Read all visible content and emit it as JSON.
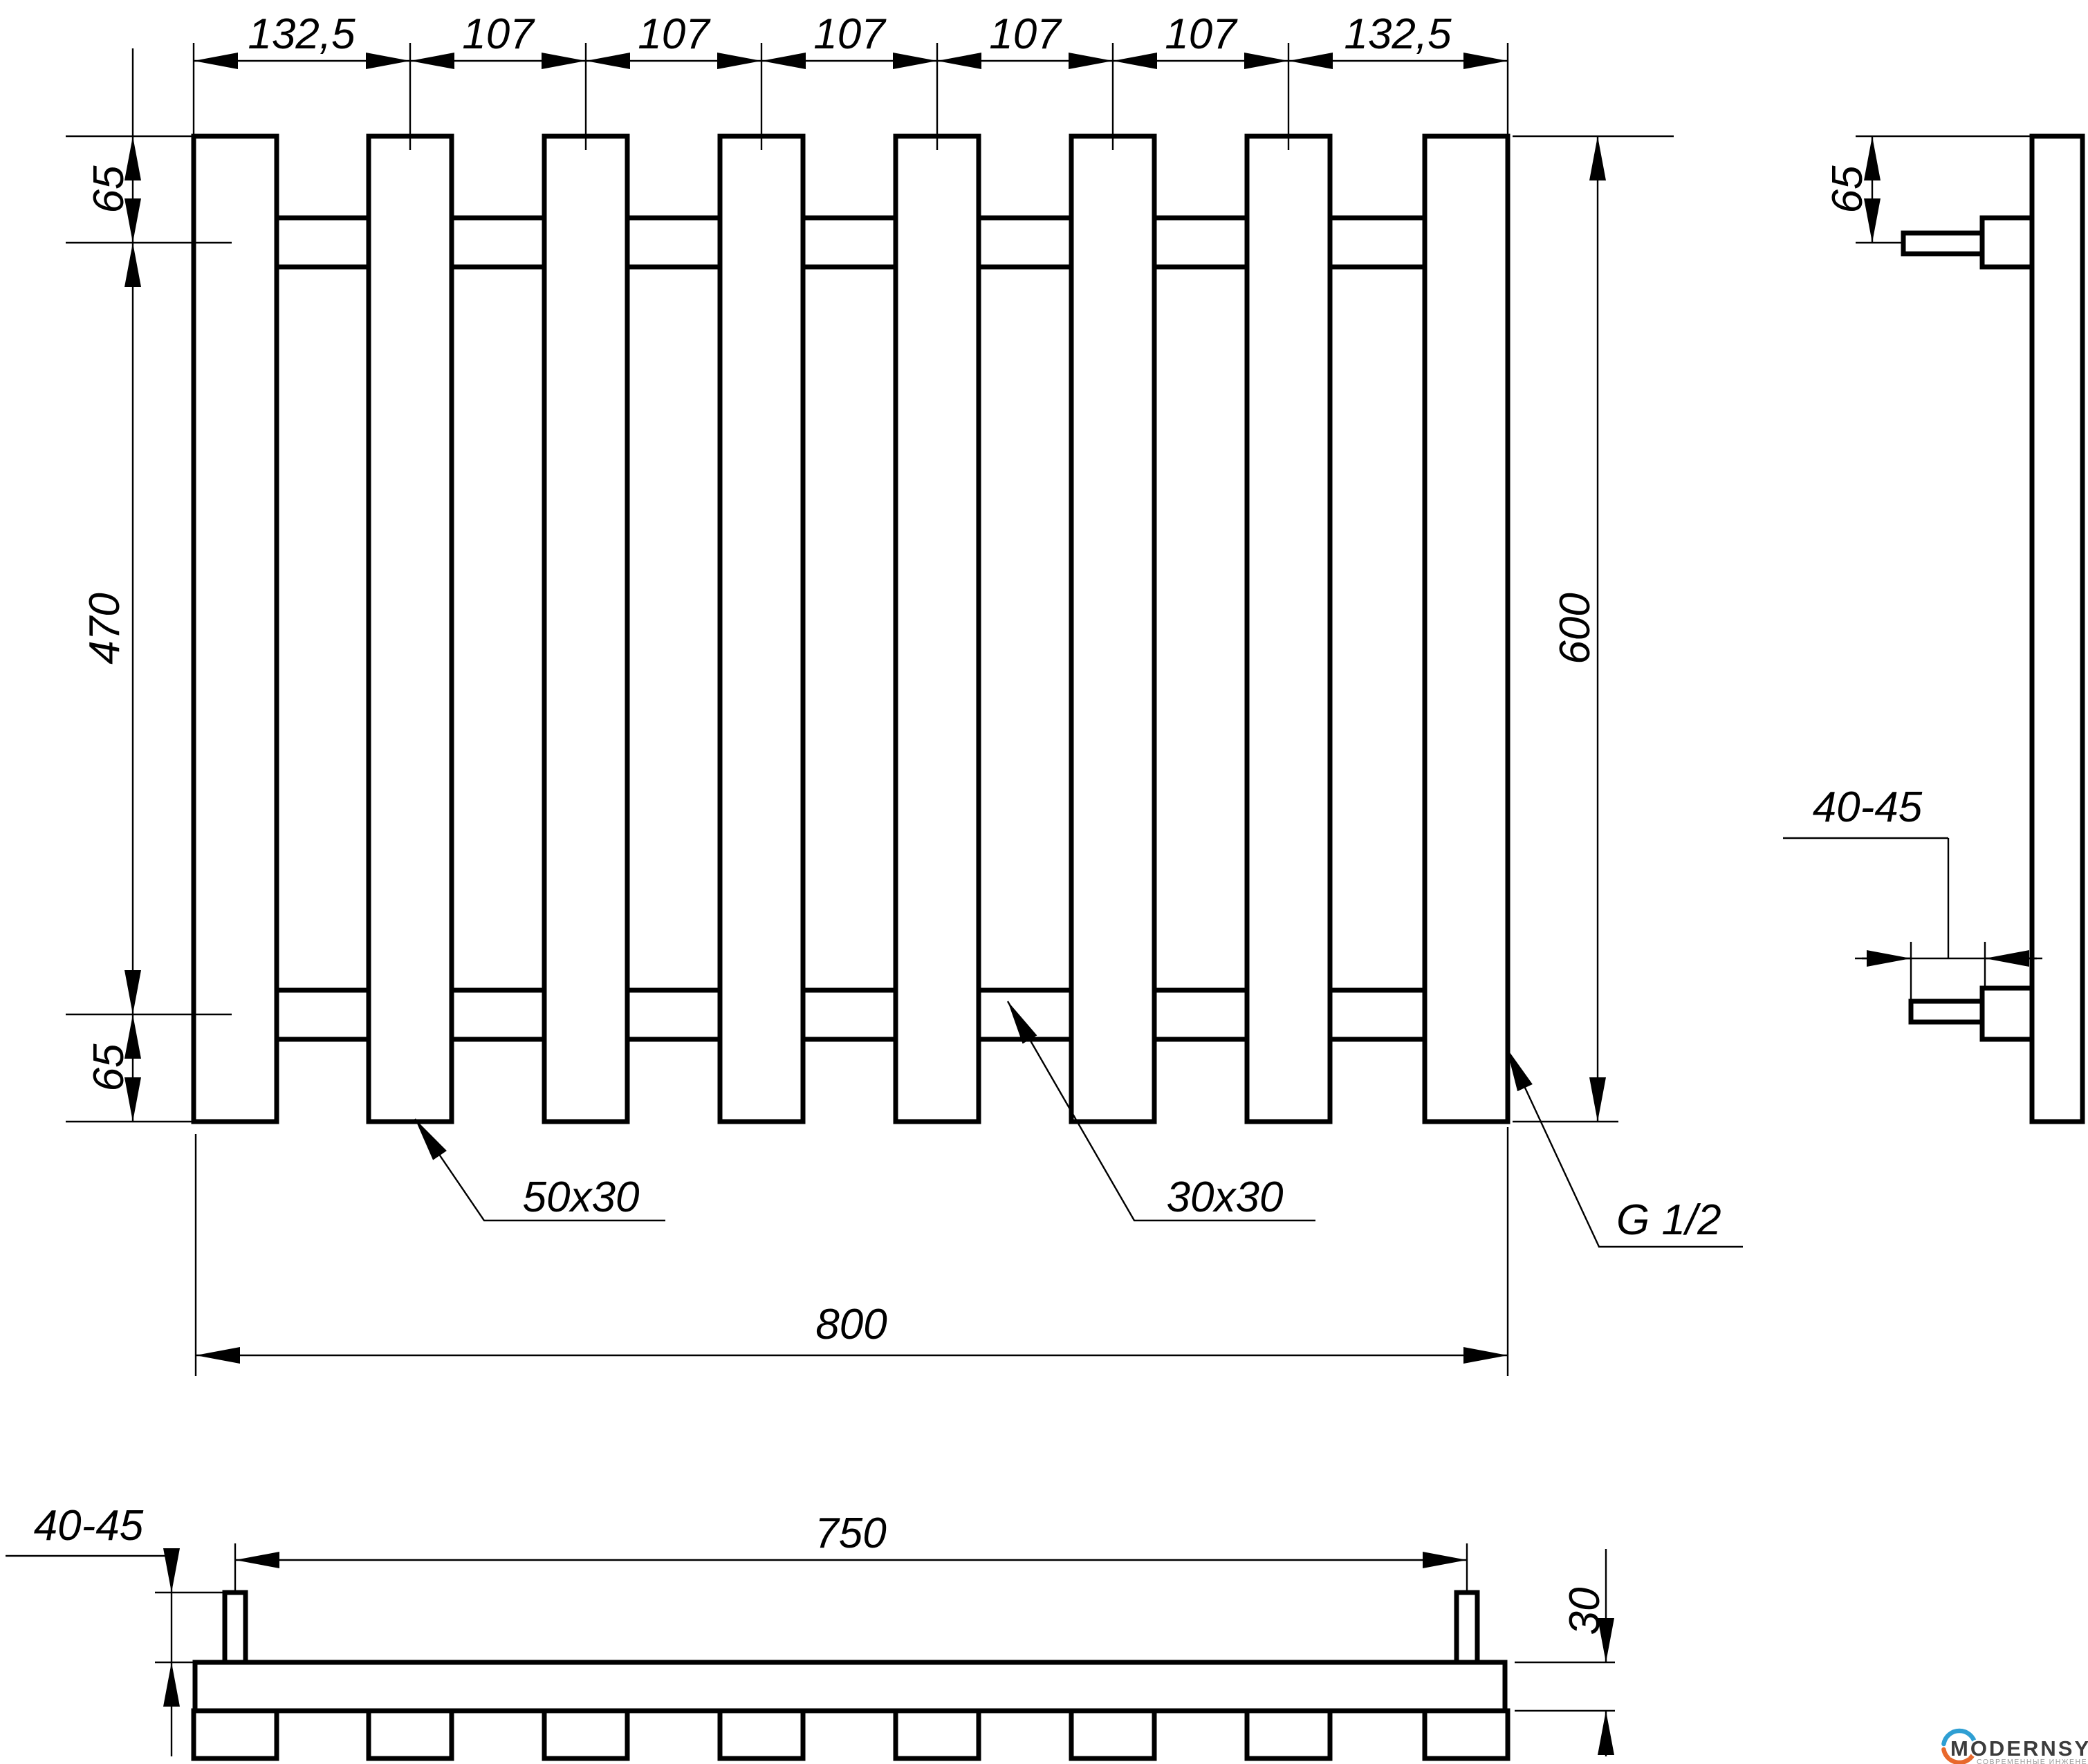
{
  "front_view": {
    "dims_top": [
      "132,5",
      "107",
      "107",
      "107",
      "107",
      "107",
      "132,5"
    ],
    "dim_left_top": "65",
    "dim_left_middle": "470",
    "dim_left_bottom": "65",
    "dim_height": "600",
    "dim_width": "800",
    "bar_profile": "50x30",
    "rail_profile": "30x30",
    "thread_label": "G 1/2"
  },
  "side_view": {
    "dim_offset_top": "65",
    "dim_pipe_length": "40-45"
  },
  "bottom_view": {
    "dim_pipe_length": "40-45",
    "dim_pipe_span": "750",
    "dim_rail_depth": "30"
  },
  "logo": {
    "brand": "MODERNSYS",
    "tagline": "СОВРЕМЕННЫЕ ИНЖЕНЕРНЫЕ СИСТЕМЫ",
    "accent_blue": "#2f9fd3",
    "accent_orange": "#e8692d",
    "brand_color": "#3c3c3c",
    "tagline_color": "#9a9a9a"
  }
}
